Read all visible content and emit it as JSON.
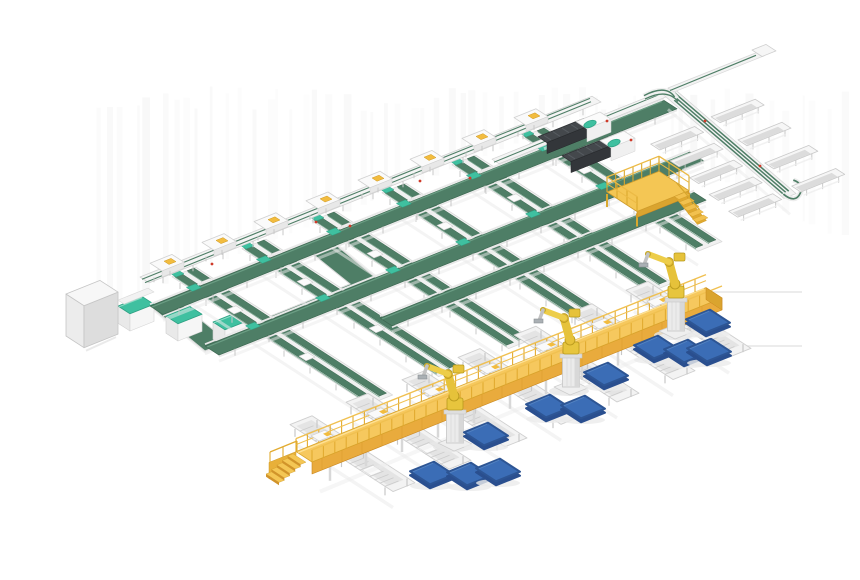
{
  "meta": {
    "label": "3D isometric render of an automated panel conveyor and robotic sortation line",
    "background": "#ffffff"
  },
  "palette": {
    "belt_green": "#4e7e66",
    "belt_green_dark": "#3e6852",
    "belt_green_light": "#6fa288",
    "teal_accent": "#3fc0a0",
    "teal_dark": "#2da183",
    "frame_white": "#f4f4f4",
    "frame_stroke": "#d2d2d2",
    "frame_inner": "#dcdcdc",
    "leg_gray": "#c8c8c8",
    "walkway_top": "#f6c85e",
    "walkway_face": "#e9ab3d",
    "walkway_deep": "#c9871f",
    "walkway_rail": "#e2ab30",
    "walkway_rail_light": "#f0c050",
    "robot_yellow": "#e6c23a",
    "robot_yellow_light": "#edcd49",
    "robot_yellow_dark": "#b89a1e",
    "pallet_top": "#3b6db6",
    "pallet_side": "#2a4f8f",
    "pallet_edge": "#2d5594",
    "machine_body": "#44484c",
    "machine_face": "#33363a",
    "machine_rib": "#565b60",
    "cabinet_front": "#ececec",
    "cabinet_side": "#dddddd",
    "shadow_soft": "#ececec",
    "streak": "#cfcfcf",
    "red_dot": "#cf3b2a"
  },
  "scene": {
    "iso": {
      "a_slope": -0.4,
      "b_slope": 0.65
    },
    "streaks": {
      "seed": 11,
      "count": 58,
      "x0": 95,
      "x1": 838,
      "y_top": 86
    },
    "floor_lines": [
      [
        697,
        292,
        802,
        292
      ],
      [
        718,
        346,
        802,
        346
      ]
    ],
    "spine": {
      "x0": 140,
      "x1": 592,
      "c": 333,
      "wb": 9,
      "stations_x": [
        152,
        204,
        256,
        308,
        360,
        412,
        464,
        516
      ]
    },
    "machine_line": {
      "x0": 492,
      "x1": 668,
      "c": 356,
      "wb": 7
    },
    "cross_belts": [
      {
        "name": "feed-belt-upper",
        "c": 366,
        "x0": 150,
        "x1": 664,
        "wb": 13
      },
      {
        "name": "cross-belt-middle",
        "c": 428,
        "x0": 205,
        "x1": 690,
        "wb": 14
      },
      {
        "name": "cross-belt-lower",
        "c": 470,
        "x0": 380,
        "x1": 694,
        "wb": 12
      }
    ],
    "lanes": [
      {
        "x0": 160
      },
      {
        "x0": 230
      },
      {
        "x0": 300
      },
      {
        "x0": 370
      },
      {
        "x0": 440
      },
      {
        "x0": 510
      }
    ],
    "walkway": {
      "x0": 296,
      "x1": 706,
      "c": 570,
      "wb": 16,
      "face_h": 12
    },
    "spurs": {
      "xs": [
        318,
        374,
        430,
        486,
        542,
        598,
        654
      ],
      "back": 28,
      "fwd": 75,
      "wa": 22
    },
    "robots": [
      {
        "x": 455,
        "y": 441
      },
      {
        "x": 571,
        "y": 385
      },
      {
        "x": 676,
        "y": 329
      }
    ],
    "pallets": [
      [
        432,
        473
      ],
      [
        469,
        474
      ],
      [
        486,
        434
      ],
      [
        498,
        470
      ],
      [
        548,
        406
      ],
      [
        583,
        407
      ],
      [
        606,
        374
      ],
      [
        656,
        347
      ],
      [
        686,
        351
      ],
      [
        709,
        350
      ],
      [
        708,
        321
      ]
    ],
    "sorter": {
      "cx": 668,
      "cy": 91,
      "ex": 790,
      "ey": 196,
      "wa": 12,
      "bins_sw_t": [
        0.3,
        0.46,
        0.62,
        0.78,
        0.94
      ],
      "bins_ne_t": [
        0.28,
        0.5,
        0.72,
        0.94
      ],
      "stub": {
        "len": 90,
        "wb": 6
      }
    },
    "machines": [
      {
        "hx": 600,
        "hy": 112
      },
      {
        "hx": 624,
        "hy": 131
      }
    ],
    "platform": {
      "x": 607,
      "y": 192,
      "la": 52,
      "lb": 30,
      "rail_h": 15
    },
    "cabinet": {
      "x": 66,
      "y": 294,
      "la": 34,
      "wb": 18,
      "h": 42
    },
    "loop": {
      "outer": [
        [
          150,
          306
        ],
        [
          325,
          236
        ],
        [
          380,
          281
        ],
        [
          205,
          351
        ]
      ],
      "inner": [
        [
          180,
          303
        ],
        [
          309,
          251
        ],
        [
          350,
          284
        ],
        [
          221,
          336
        ]
      ],
      "machines": [
        [
          118,
          306
        ],
        [
          166,
          316
        ],
        [
          213,
          322
        ]
      ]
    },
    "dots_red": [
      [
        212,
        264
      ],
      [
        316,
        222
      ],
      [
        420,
        181
      ],
      [
        350,
        226
      ],
      [
        470,
        178
      ],
      [
        705,
        121
      ],
      [
        760,
        166
      ]
    ]
  }
}
